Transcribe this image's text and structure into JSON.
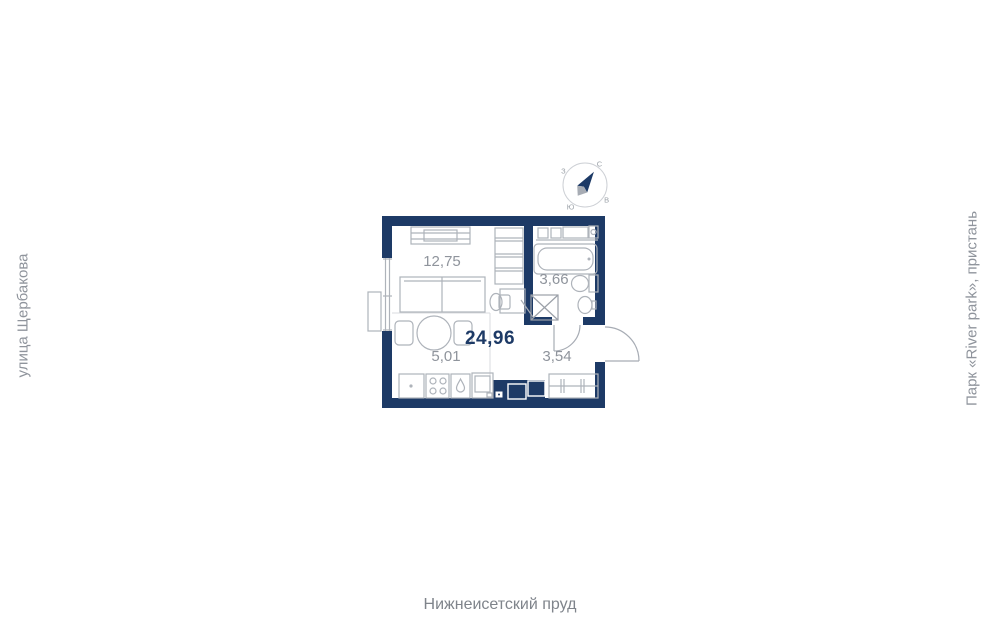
{
  "plan": {
    "total_area": "24,96",
    "rooms": {
      "living": {
        "area": "12,75"
      },
      "bathroom": {
        "area": "3,66"
      },
      "kitchen": {
        "area": "5,01"
      },
      "hallway": {
        "area": "3,54"
      }
    }
  },
  "compass": {
    "north_label": "С",
    "east_label": "В",
    "south_label": "Ю",
    "west_label": "З"
  },
  "surroundings": {
    "left": "улица Щербакова",
    "right": "Парк «River park», пристань",
    "bottom": "Нижнеисетский пруд"
  },
  "colors": {
    "wall": "#1d3a66",
    "total_text": "#1d3a66",
    "area_text": "#8f949c",
    "furniture_line": "#aeb3ba",
    "background": "#ffffff"
  }
}
